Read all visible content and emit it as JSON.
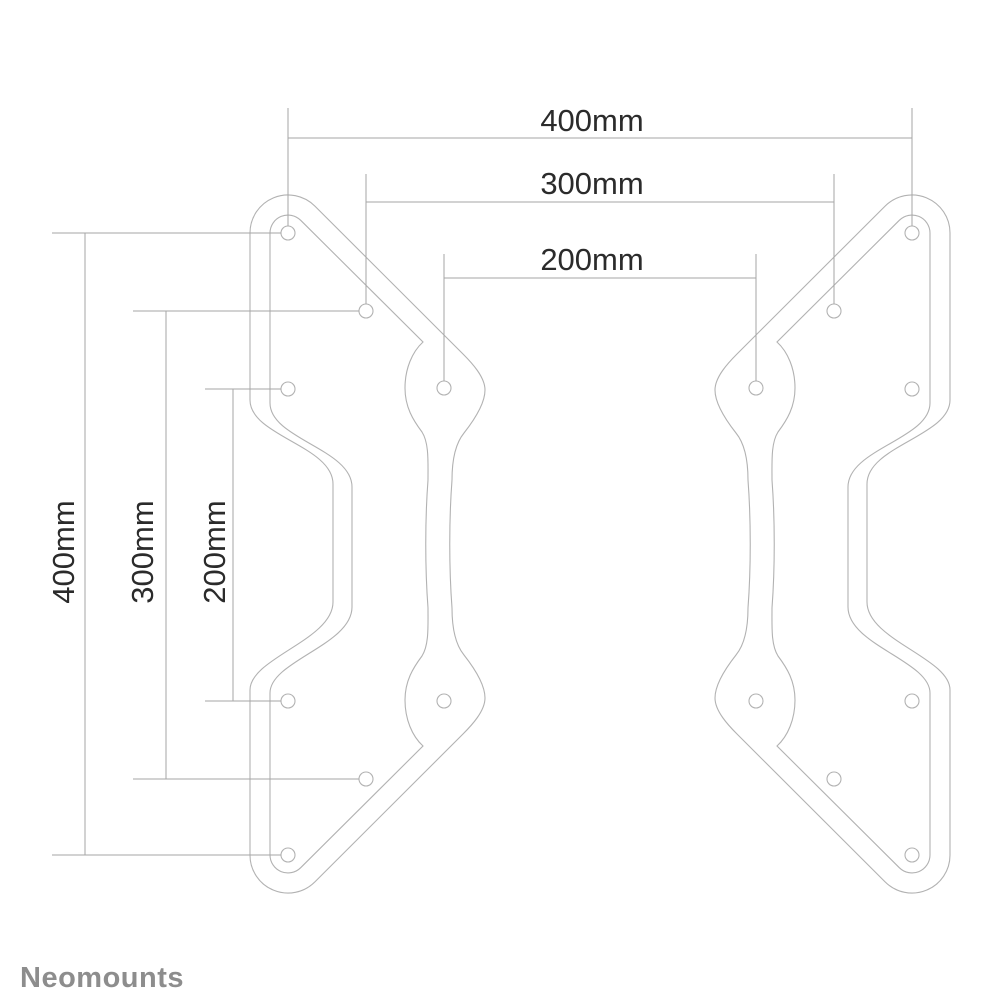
{
  "drawing": {
    "type": "technical-dimension-drawing",
    "subject": "vesa-adapter-bracket-pair",
    "horizontal_dimensions": [
      {
        "label": "400mm",
        "value_mm": 400
      },
      {
        "label": "300mm",
        "value_mm": 300
      },
      {
        "label": "200mm",
        "value_mm": 200
      }
    ],
    "vertical_dimensions": [
      {
        "label": "400mm",
        "value_mm": 400
      },
      {
        "label": "300mm",
        "value_mm": 300
      },
      {
        "label": "200mm",
        "value_mm": 200
      }
    ]
  },
  "branding": {
    "logo_text": "Neomounts",
    "logo_color": "#8d8d8d"
  },
  "colors": {
    "background": "#ffffff",
    "bracket_outline": "#b2b2b2",
    "dimension_lines": "#a5a5a5",
    "dimension_text": "#2b2b2b"
  }
}
